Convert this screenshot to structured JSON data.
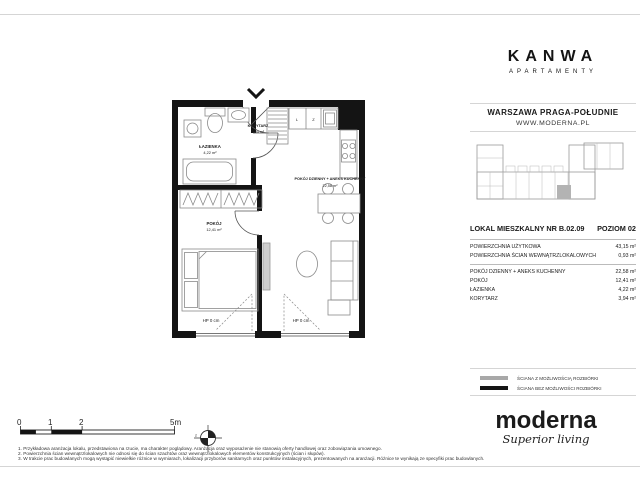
{
  "brand": {
    "name": "KANWA",
    "subtitle": "APARTAMENTY",
    "location": "WARSZAWA PRAGA-POŁUDNIE",
    "website": "WWW.MODERNA.PL"
  },
  "unit": {
    "title": "LOKAL MIESZKALNY NR B.02.09",
    "level": "POZIOM 02",
    "summary": [
      {
        "label": "POWIERZCHNIA UŻYTKOWA",
        "value": "43,15 m²"
      },
      {
        "label": "POWIERZCHNIA ŚCIAN WEWNĄTRZLOKALOWYCH",
        "value": "0,93 m²"
      }
    ],
    "rooms": [
      {
        "label": "POKÓJ DZIENNY + ANEKS KUCHENNY",
        "value": "22,58 m²"
      },
      {
        "label": "POKÓJ",
        "value": "12,41 m²"
      },
      {
        "label": "ŁAZIENKA",
        "value": "4,22 m²"
      },
      {
        "label": "KORYTARZ",
        "value": "3,94 m²"
      }
    ]
  },
  "plan": {
    "rooms": [
      {
        "name": "ŁAZIENKA",
        "area": "4,22 m²"
      },
      {
        "name": "KORYTARZ",
        "area": "3,94 m²"
      },
      {
        "name": "POKÓJ DZIENNY + ANEKS KUCHENNY",
        "area": "22,58 m²"
      },
      {
        "name": "POKÓJ",
        "area": "12,41 m²"
      }
    ],
    "kitchen_labels": [
      "L",
      "Z"
    ],
    "window_labels": [
      "HP 0 cm",
      "HP 0 cm"
    ],
    "wall_color": "#141414"
  },
  "legend": [
    {
      "color": "#a8a8a8",
      "label": "ŚCIANA Z MOŻLIWOŚCIĄ ROZBIÓRKI"
    },
    {
      "color": "#151515",
      "label": "ŚCIANA BEZ MOŻLIWOŚCI ROZBIÓRKI"
    }
  ],
  "footer_brand": {
    "name": "moderna",
    "tagline": "Superior living"
  },
  "scalebar": {
    "labels": [
      "0",
      "1",
      "2",
      "5m"
    ]
  },
  "compass": {
    "label": "z"
  },
  "footnotes": [
    "1.  Przykładowa aranżacja lokalu, przedstawiona na rzucie, ma charakter poglądowy. Aranżacja oraz wyposażenie nie stanowią oferty handlowej oraz zobowiązania umownego.",
    "2.  Powierzchnia ścian wewnątrzlokalowych nie odnosi się do ścian szachtów oraz wewnątrzlokalowych elementów konstrukcyjnych (ścian i słupów).",
    "3.  W trakcie prac budowlanych mogą wystąpić niewielkie różnice w wymiarach, lokalizacji przyborów sanitarnych oraz punktów instalacyjnych, prezentowanych na aranżacji. Różnice te wynikają ze specyfiki prac budowlanych."
  ]
}
